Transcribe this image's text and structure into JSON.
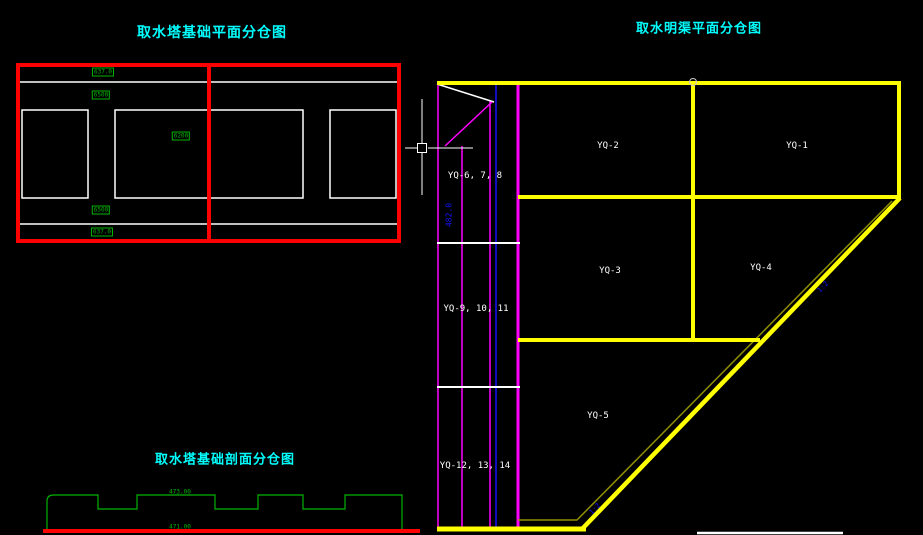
{
  "window": {
    "width": 923,
    "height": 535,
    "background": "#000000"
  },
  "colors": {
    "black": "#000000",
    "white": "#FFFFFF",
    "cyan": "#00FFFF",
    "red": "#FF0000",
    "yellow": "#FFFF00",
    "magenta": "#FF00FF",
    "blue": "#1414FF",
    "green": "#00B400",
    "olive": "#8F8F00",
    "gray": "#C8C8C8"
  },
  "titles": {
    "foundation_plan": "取水塔基础平面分仓图",
    "channel_plan": "取水明渠平面分仓图",
    "foundation_section": "取水塔基础剖面分仓图"
  },
  "foundation_plan": {
    "dim_labels": [
      "637.0",
      "6500",
      "6200",
      "6500",
      "637.0"
    ]
  },
  "strip": {
    "compartments": [
      "YQ-6, 7, 8",
      "YQ-9, 10, 11",
      "YQ-12, 13, 14"
    ],
    "elevation_label": "482.0"
  },
  "channel_plan": {
    "compartments": [
      "YQ-1",
      "YQ-2",
      "YQ-3",
      "YQ-4",
      "YQ-5"
    ],
    "slope_labels": [
      "1:2",
      "1:2"
    ]
  },
  "section": {
    "top_elevation": "473.00",
    "bottom_elevation": "471.00"
  }
}
